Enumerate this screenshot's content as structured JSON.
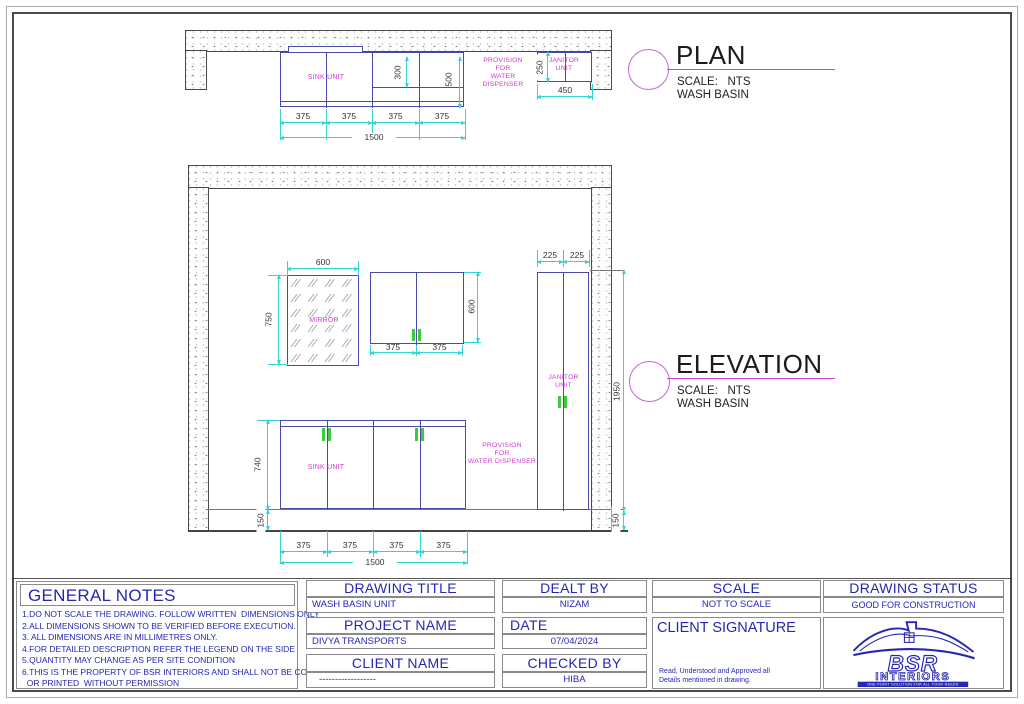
{
  "drawing": {
    "plan": {
      "title": "PLAN",
      "scale": "SCALE:   NTS",
      "subtitle": "WASH BASIN",
      "sink_label": "SINK UNIT",
      "provision": [
        "PROVISION",
        "FOR",
        "WATER DISPENSER"
      ],
      "janitor": [
        "JANITOR",
        "UNIT"
      ],
      "d375": "375",
      "d1500": "1500",
      "d300": "300",
      "d500": "500",
      "d250": "250",
      "d450": "450"
    },
    "elevation": {
      "title": "ELEVATION",
      "scale": "SCALE:   NTS",
      "subtitle": "WASH BASIN",
      "mirror_label": "MIRROR",
      "sink_label": "SINK UNIT",
      "provision": [
        "PROVISION",
        "FOR",
        "WATER DISPENSER"
      ],
      "janitor": [
        "JANITOR",
        "UNIT"
      ],
      "d600": "600",
      "d750": "750",
      "d375": "375",
      "d225": "225",
      "d1950": "1950",
      "d150": "150",
      "d740": "740",
      "d1500": "1500"
    }
  },
  "titleblock": {
    "general_notes": {
      "heading": "GENERAL NOTES",
      "notes": [
        "1.DO NOT SCALE THE DRAWING. FOLLOW WRITTEN  DIMENSIONS ONLY",
        "2.ALL DIMENSIONS SHOWN TO BE VERIFIED BEFORE EXECUTION.",
        "3. ALL DIMENSIONS ARE IN MILLIMETRES ONLY.",
        "4.FOR DETAILED DESCRIPTION REFER THE LEGEND ON THE SIDE",
        "5.QUANTITY MAY CHANGE AS PER SITE CONDITION",
        "6.THIS IS THE PROPERTY OF BSR INTERIORS AND SHALL NOT BE COPIED",
        "  OR PRINTED  WITHOUT PERMISSION"
      ]
    },
    "drawing_title": {
      "label": "DRAWING TITLE",
      "value": "WASH BASIN UNIT"
    },
    "project_name": {
      "label": "PROJECT NAME",
      "value": "DIVYA TRANSPORTS"
    },
    "client_name": {
      "label": "CLIENT NAME",
      "value": "------------------"
    },
    "dealt_by": {
      "label": "DEALT BY",
      "value": "NIZAM"
    },
    "date": {
      "label": "DATE",
      "value": "07/04/2024"
    },
    "checked_by": {
      "label": "CHECKED BY",
      "value": "HIBA"
    },
    "scale": {
      "label": "SCALE",
      "value": "NOT TO SCALE"
    },
    "client_signature": {
      "label": "CLIENT SIGNATURE",
      "notes": [
        "Read, Understood and Approved all",
        "Details mentioned in drawing."
      ]
    },
    "drawing_status": {
      "label": "DRAWING STATUS",
      "value": "GOOD FOR CONSTRUCTION"
    },
    "logo": {
      "brand": "BSR",
      "name": "INTERIORS",
      "tagline": "ONE POINT SOLUTION FOR ALL YOUR NEEDS"
    }
  },
  "colors": {
    "dimension": "#35d4d4",
    "cabinet": "#4a4aa8",
    "label": "#cc3ecc",
    "accent": "#cc44cc",
    "blueprint_text": "#2527b4",
    "handle": "#3fc93f"
  }
}
